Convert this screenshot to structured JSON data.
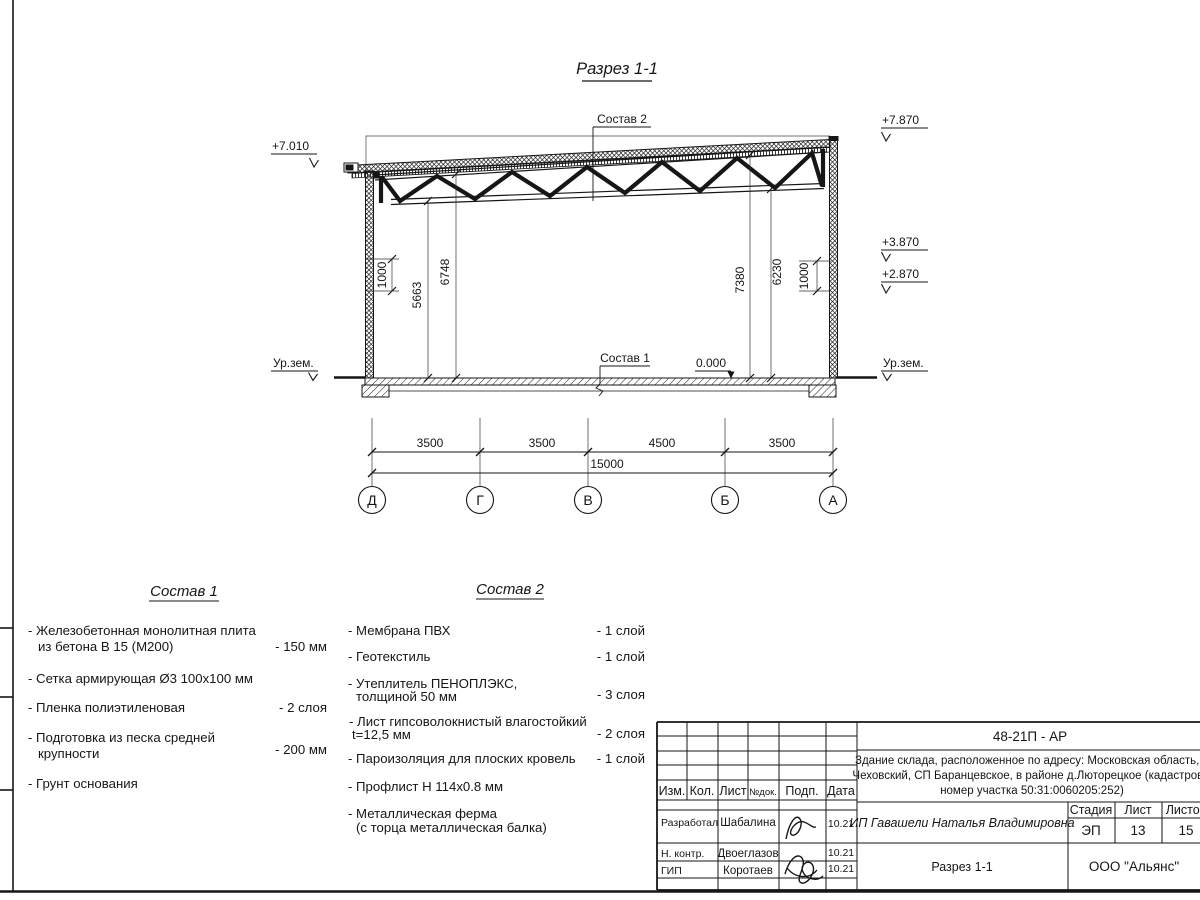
{
  "drawing": {
    "section_title": "Разрез 1-1",
    "elevations": {
      "left_eave": "+7.010",
      "right_parapet": "+7.870",
      "right_upper": "+3.870",
      "right_lower": "+2.870",
      "floor_zero": "0.000",
      "ground_left": "Ур.зем.",
      "ground_right": "Ур.зем."
    },
    "leaders": {
      "roof": "Состав 2",
      "floor": "Состав 1"
    },
    "vertical_dims": {
      "wall_left": "1000",
      "truss_bottom_left": "5663",
      "truss_top_left": "6748",
      "roof_right": "7380",
      "truss_bottom_right": "6230",
      "wall_right": "1000"
    },
    "bottom_dims": {
      "spans": [
        "3500",
        "3500",
        "4500",
        "3500"
      ],
      "total": "15000"
    },
    "axes": [
      "Д",
      "Г",
      "В",
      "Б",
      "А"
    ]
  },
  "sostav1": {
    "heading": "Состав 1",
    "items": [
      {
        "line1": "- Железобетонная  монолитная плита",
        "line2": "из бетона В 15 (М200)",
        "value": "- 150 мм"
      },
      {
        "line1": "- Сетка армирующая Ø3 100х100 мм",
        "line2": "",
        "value": ""
      },
      {
        "line1": "- Пленка полиэтиленовая",
        "line2": "",
        "value": "-  2 слоя"
      },
      {
        "line1": "- Подготовка из песка средней",
        "line2": "крупности",
        "value": "- 200 мм"
      },
      {
        "line1": "- Грунт основания",
        "line2": "",
        "value": ""
      }
    ]
  },
  "sostav2": {
    "heading": "Состав 2",
    "items": [
      {
        "line1": "- Мембрана ПВХ",
        "line2": "",
        "value": "- 1 слой"
      },
      {
        "line1": "- Геотекстиль",
        "line2": "",
        "value": "- 1 слой"
      },
      {
        "line1": "- Утеплитель ПЕНОПЛЭКС,",
        "line2": "толщиной 50 мм",
        "value": "- 3 слоя"
      },
      {
        "line1": "- Лист гипсоволокнистый влагостойкий",
        "line2": "t=12,5 мм",
        "value": "- 2 слоя"
      },
      {
        "line1": "- Пароизоляция для плоских кровель",
        "line2": "",
        "value": "- 1 слой"
      },
      {
        "line1": "- Профлист Н 114х0.8 мм",
        "line2": "",
        "value": ""
      },
      {
        "line1": "- Металлическая ферма",
        "line2": "(с торца металлическая балка)",
        "value": ""
      }
    ]
  },
  "titleblock": {
    "doc_number": "48-21П - АР",
    "description": [
      "Здание склада, расположенное по адресу: Московская область, р",
      "Чеховский, СП Баранцевское, в районе д.Люторецкое  (кадастровы",
      "номер участка 50:31:0060205:252)"
    ],
    "rev_headers": [
      "Изм.",
      "Кол.",
      "Лист",
      "№док.",
      "Подп.",
      "Дата"
    ],
    "signature_rows": [
      {
        "role": "Разработал",
        "name": "Шабалина",
        "date": "10.21"
      },
      {
        "role": "Н. контр.",
        "name": "Двоеглазов",
        "date": "10.21"
      },
      {
        "role": "ГИП",
        "name": "Коротаев",
        "date": "10.21"
      }
    ],
    "client": "ИП Гавашели Наталья Владимировна",
    "stage_label": "Стадия",
    "sheet_label": "Лист",
    "sheets_label": "Листов",
    "stage": "ЭП",
    "sheet": "13",
    "sheets": "15",
    "drawing_name": "Разрез 1-1",
    "company": "ООО \"Альянс\""
  }
}
